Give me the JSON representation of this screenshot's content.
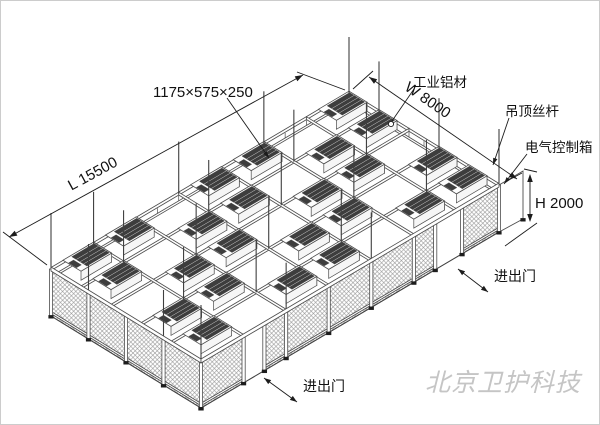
{
  "labels": {
    "module_size": "1175×575×250",
    "material": "工业铝材",
    "width": "W 8000",
    "ceiling_rod": "吊顶丝杆",
    "control_box": "电气控制箱",
    "length": "L 15500",
    "height": "H 2000",
    "door_bottom": "进出门",
    "door_right": "进出门",
    "watermark": "北京卫护科技"
  },
  "structure": {
    "length_bays": 7,
    "width_bays": 5,
    "ffu_units": 24,
    "left_wall_panels": 4,
    "front_doors": 2,
    "suspension_rods": 25
  },
  "colors": {
    "line": "#4d4d4d",
    "dark": "#3d3d3d",
    "mesh": "#8f8f8f",
    "annotation": "#1c1c1c",
    "watermark": "#c5c5c5",
    "background": "#ffffff"
  }
}
